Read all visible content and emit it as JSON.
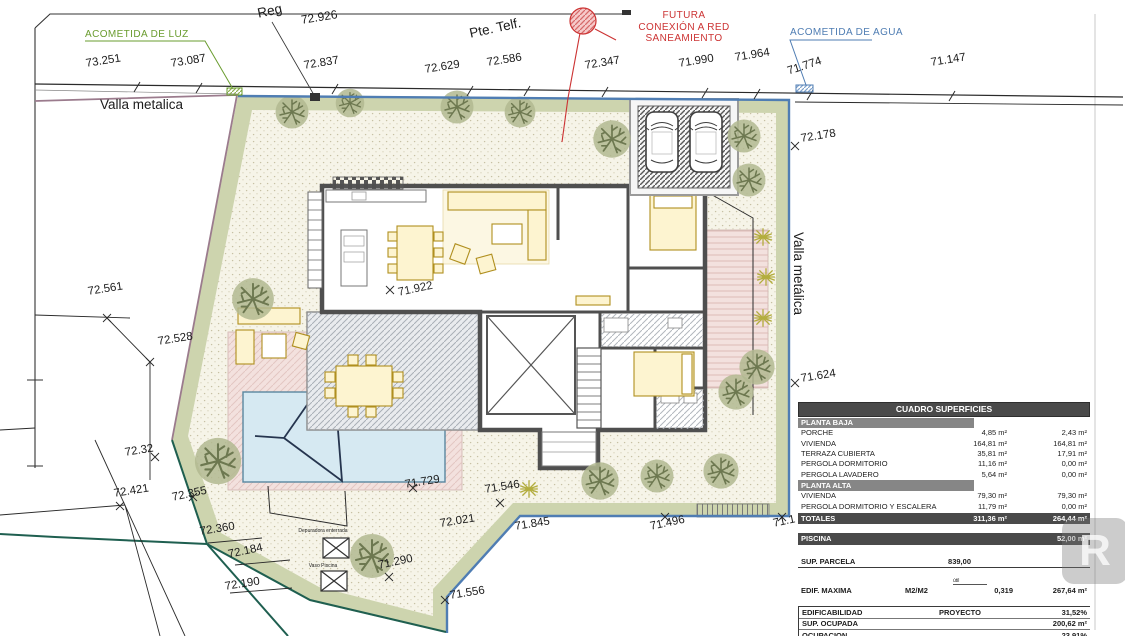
{
  "markers": {
    "acometida_luz": "ACOMETIDA DE LUZ",
    "acometida_agua": "ACOMETIDA DE AGUA",
    "futura_line1": "FUTURA",
    "futura_line2": "CONEXIÓN A RED",
    "futura_line3": "SANEAMIENTO",
    "pte_telf": "Pte. Telf.",
    "reg": "Reg",
    "valla_top": "Valla metalica",
    "valla_right": "Valla metálica"
  },
  "levels": {
    "v73_251": "73.251",
    "v73_087": "73.087",
    "v72_926": "72.926",
    "v72_837": "72.837",
    "v72_629": "72.629",
    "v72_586": "72.586",
    "v72_347": "72.347",
    "v71_990": "71.990",
    "v71_964": "71.964",
    "v71_774": "71.774",
    "v71_147": "71.147",
    "v72_178": "72.178",
    "v71_624": "71.624",
    "v72_561": "72.561",
    "v72_528": "72.528",
    "v72_32": "72.32",
    "v72_421": "72.421",
    "v72_355": "72.355",
    "v72_360": "72.360",
    "v72_184": "72.184",
    "v72_190": "72.190",
    "v71_290": "71.290",
    "v71_556": "71.556",
    "v71_729": "71.729",
    "v71_546": "71.546",
    "v72_021": "72.021",
    "v71_845": "71.845",
    "v71_496": "71.496",
    "v71_1": "71.1",
    "v71_922": "71.922"
  },
  "pool_area": {
    "depuradora": "Depuradora enterrada",
    "vaso": "Vaso Piscina"
  },
  "table": {
    "title": "CUADRO SUPERFICIES",
    "pb": {
      "header": "PLANTA BAJA",
      "rows": [
        [
          "PORCHE",
          "4,85 m²",
          "2,43 m²"
        ],
        [
          "VIVIENDA",
          "164,81 m²",
          "164,81 m²"
        ],
        [
          "TERRAZA CUBIERTA",
          "35,81 m²",
          "17,91 m²"
        ],
        [
          "PERGOLA DORMITORIO",
          "11,16 m²",
          "0,00 m²"
        ],
        [
          "PERGOLA LAVADERO",
          "5,64 m²",
          "0,00 m²"
        ]
      ]
    },
    "pa": {
      "header": "PLANTA ALTA",
      "rows": [
        [
          "VIVIENDA",
          "79,30 m²",
          "79,30 m²"
        ],
        [
          "PERGOLA DORMITORIO Y ESCALERA",
          "11,79 m²",
          "0,00 m²"
        ]
      ]
    },
    "totales": [
      "TOTALES",
      "311,36 m²",
      "264,44 m²"
    ],
    "piscina": [
      "PISCINA",
      "52,00 m²"
    ],
    "sup_parcela": [
      "SUP. PARCELA",
      "839,00"
    ],
    "edif_maxima": {
      "label": "EDIF. MAXIMA",
      "unit": "M2/M2",
      "coef_label": "útil",
      "coef": "0,319",
      "value": "267,64 m²"
    },
    "bottom_rows": [
      [
        "EDIFICABILIDAD",
        "PROYECTO",
        "31,52%"
      ],
      [
        "SUP. OCUPADA",
        "",
        "200,62 m²"
      ],
      [
        "OCUPACION",
        "",
        "23,91%"
      ]
    ]
  },
  "watermark_letter": "R",
  "colors": {
    "water_line": "#4f7db3",
    "fence_line": "#1f5f50",
    "boundary_purple": "#9b7b8d",
    "luz_green": "#6a9c2f",
    "red": "#cc3333"
  }
}
